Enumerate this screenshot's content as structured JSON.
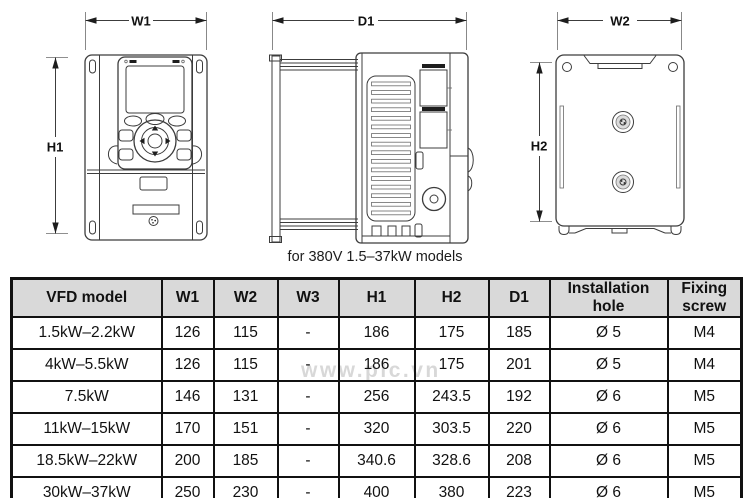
{
  "page": {
    "caption": "for 380V 1.5–37kW models",
    "watermark": "www.plc.vn"
  },
  "diagrams": {
    "front": {
      "width_label": "W1",
      "height_label": "H1"
    },
    "side": {
      "depth_label": "D1"
    },
    "back": {
      "width_label": "W2",
      "height_label": "H2"
    }
  },
  "table": {
    "headers": [
      "VFD model",
      "W1",
      "W2",
      "W3",
      "H1",
      "H2",
      "D1",
      "Installation hole",
      "Fixing screw"
    ],
    "rows": [
      [
        "1.5kW–2.2kW",
        "126",
        "115",
        "-",
        "186",
        "175",
        "185",
        "Ø 5",
        "M4"
      ],
      [
        "4kW–5.5kW",
        "126",
        "115",
        "-",
        "186",
        "175",
        "201",
        "Ø 5",
        "M4"
      ],
      [
        "7.5kW",
        "146",
        "131",
        "-",
        "256",
        "243.5",
        "192",
        "Ø 6",
        "M5"
      ],
      [
        "11kW–15kW",
        "170",
        "151",
        "-",
        "320",
        "303.5",
        "220",
        "Ø 6",
        "M5"
      ],
      [
        "18.5kW–22kW",
        "200",
        "185",
        "-",
        "340.6",
        "328.6",
        "208",
        "Ø 6",
        "M5"
      ],
      [
        "30kW–37kW",
        "250",
        "230",
        "-",
        "400",
        "380",
        "223",
        "Ø 6",
        "M5"
      ]
    ]
  },
  "colors": {
    "header_bg": "#d9d9d9",
    "table_border": "#111111",
    "line_art": "#3c3c3c",
    "watermark": "#b8b8b8"
  }
}
